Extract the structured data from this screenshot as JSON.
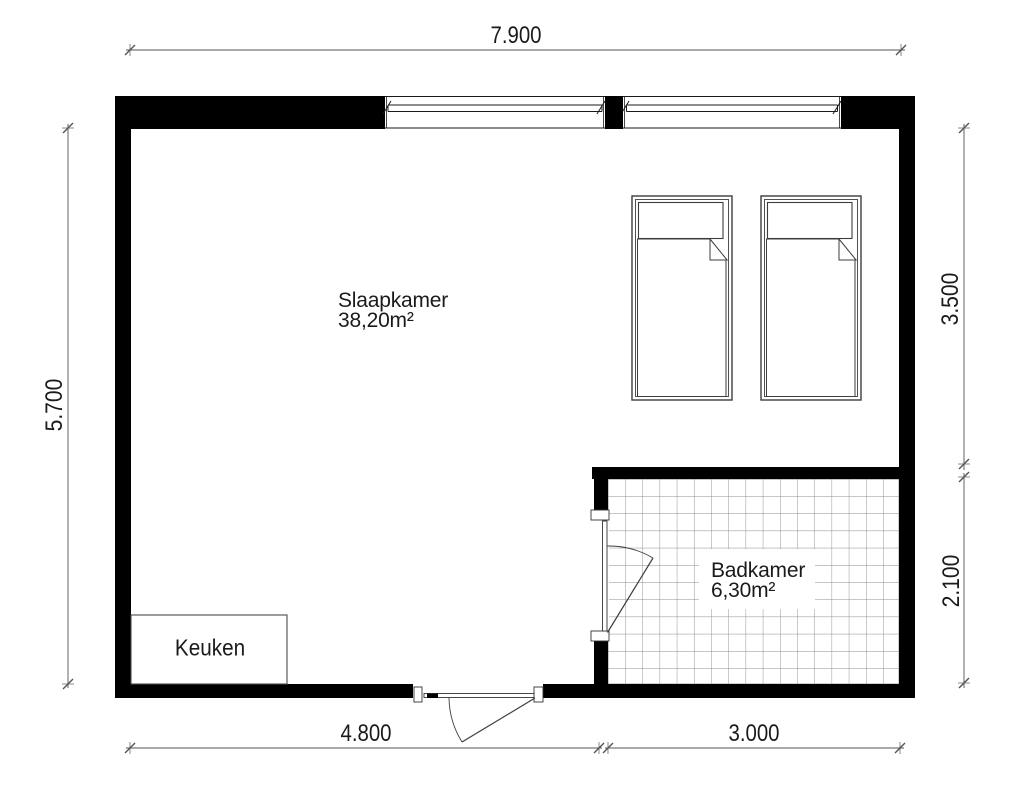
{
  "plan": {
    "rooms": {
      "slaapkamer": {
        "label": "Slaapkamer",
        "area": "38,20m²"
      },
      "badkamer": {
        "label": "Badkamer",
        "area": "6,30m²"
      },
      "keuken": {
        "label": "Keuken"
      }
    },
    "dimensions": {
      "top": "7.900",
      "left": "5.700",
      "right_upper": "3.500",
      "right_lower": "2.100",
      "bottom_left": "4.800",
      "bottom_right": "3.000"
    }
  },
  "colors": {
    "wall": "#000000",
    "line": "#3d3d3d",
    "dim_line": "#555555",
    "tile_line": "#8a8a8a",
    "text": "#1a1a1a"
  }
}
